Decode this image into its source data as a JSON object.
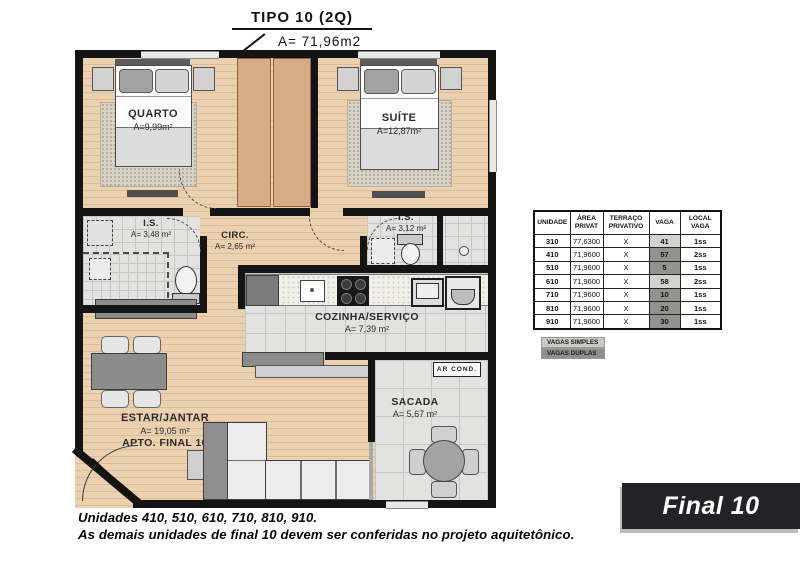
{
  "title": "TIPO 10 (2Q)",
  "title_area": "A= 71,96m2",
  "rooms": {
    "quarto": {
      "name": "QUARTO",
      "area": "A=9,99m²"
    },
    "suite": {
      "name": "SUÍTE",
      "area": "A=12,87m²"
    },
    "is_esq": {
      "name": "I.S.",
      "area": "A= 3,48 m²"
    },
    "circ": {
      "name": "CIRC.",
      "area": "A= 2,65 m²"
    },
    "is_dir": {
      "name": "I.S.",
      "area": "A= 3,12 m²"
    },
    "cozinha": {
      "name": "COZINHA/SERVIÇO",
      "area": "A= 7,39 m²"
    },
    "estar": {
      "name": "ESTAR/JANTAR",
      "area": "A= 19,05 m²",
      "apto": "APTO. FINAL 10"
    },
    "sacada": {
      "name": "SACADA",
      "area": "A= 5,67 m²"
    },
    "ar_cond": "AR COND."
  },
  "table": {
    "headers": {
      "unidade": "UNIDADE",
      "area": "ÁREA\nPRIVAT",
      "terraco": "TERRAÇO\nPRIVATIVO",
      "vaga": "VAGA",
      "local": "LOCAL\nVAGA"
    },
    "rows": [
      {
        "unidade": "310",
        "area": "77,6300",
        "terraco": "X",
        "vaga": "41",
        "vaga_type": "simples",
        "local": "1ss"
      },
      {
        "unidade": "410",
        "area": "71,9600",
        "terraco": "X",
        "vaga": "57",
        "vaga_type": "duplas",
        "local": "2ss"
      },
      {
        "unidade": "510",
        "area": "71,9600",
        "terraco": "X",
        "vaga": "5",
        "vaga_type": "duplas",
        "local": "1ss"
      },
      {
        "unidade": "610",
        "area": "71,9600",
        "terraco": "X",
        "vaga": "58",
        "vaga_type": "simples",
        "local": "2ss"
      },
      {
        "unidade": "710",
        "area": "71,9600",
        "terraco": "X",
        "vaga": "10",
        "vaga_type": "duplas",
        "local": "1ss"
      },
      {
        "unidade": "810",
        "area": "71,9600",
        "terraco": "X",
        "vaga": "20",
        "vaga_type": "duplas",
        "local": "1ss"
      },
      {
        "unidade": "910",
        "area": "71,9600",
        "terraco": "X",
        "vaga": "30",
        "vaga_type": "duplas",
        "local": "1ss"
      }
    ],
    "legend": {
      "simples": "VAGAS SIMPLES",
      "duplas": "VAGAS DUPLAS"
    }
  },
  "badge": "Final 10",
  "notes": {
    "line1": "Unidades 410, 510, 610, 710, 810, 910.",
    "line2": "As demais unidades de final 10 devem ser conferidas no projeto aquitetônico."
  },
  "colors": {
    "vaga_simples": "#d2d2ce",
    "vaga_duplas": "#92928f",
    "wall": "#141414",
    "wood_floor": "#ecd1b0",
    "tile_floor": "#e2e2e0",
    "badge_bg": "#232327"
  }
}
